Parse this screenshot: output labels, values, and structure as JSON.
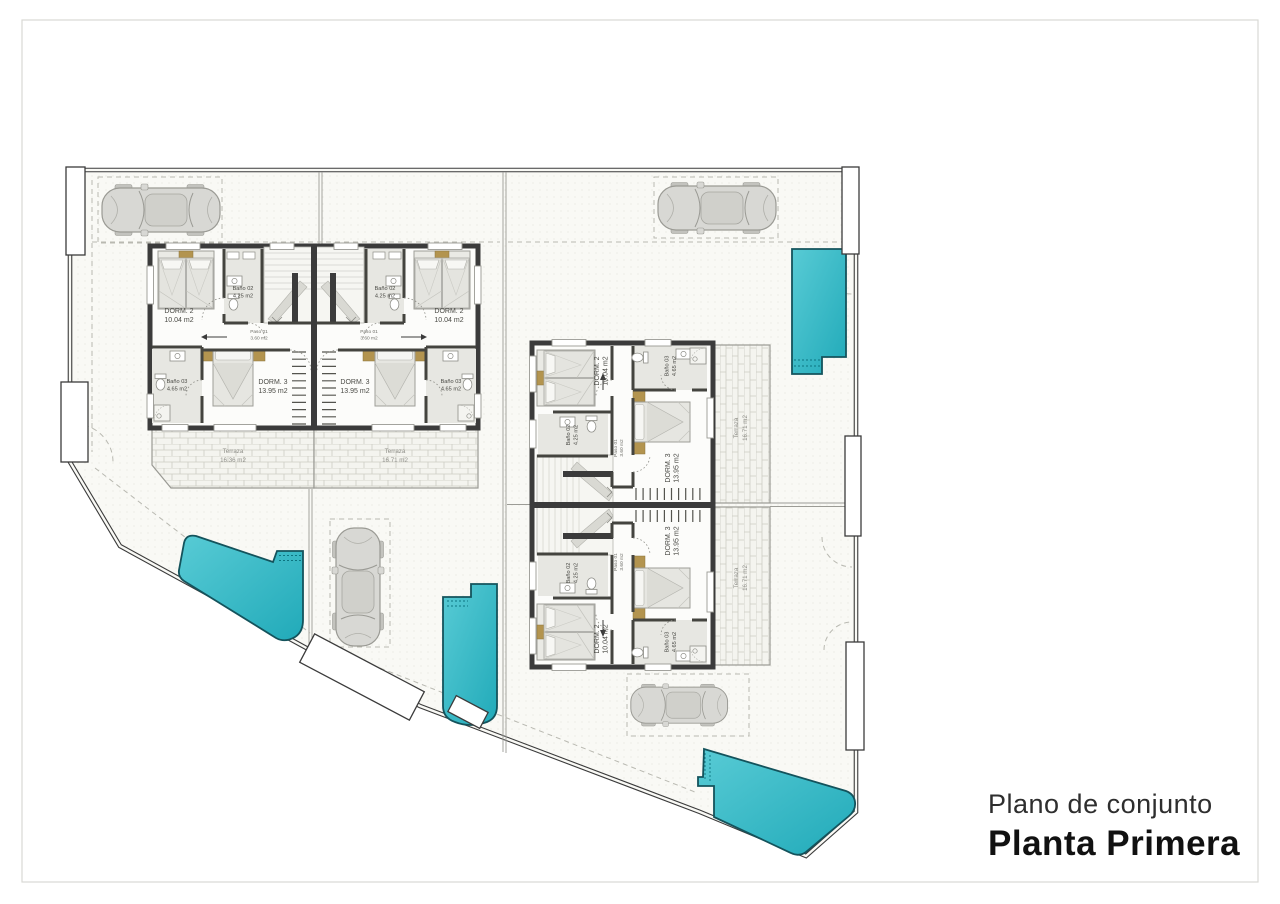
{
  "sheet": {
    "subtitle": "Plano de conjunto",
    "title": "Planta Primera"
  },
  "rooms": {
    "dorm2": {
      "name": "DORM. 2",
      "area": "10.04 m2"
    },
    "bano02": {
      "name": "Baño 02",
      "area": "4.25 m2"
    },
    "paso01": {
      "name": "Paso 01",
      "area": "3.60 m2"
    },
    "dorm3": {
      "name": "DORM. 3",
      "area": "13.95 m2"
    },
    "bano03": {
      "name": "Baño 03",
      "area": "4.65 m2"
    },
    "terraza_left": {
      "name": "Terraza",
      "area": "16.36 m2"
    },
    "terraza_right": {
      "name": "Terraza",
      "area": "16.71 m2"
    }
  },
  "colors": {
    "pool": "#3fc0cb",
    "pool_deep": "#21aab9",
    "wall": "#3b3b3b",
    "wood_accent": "#b3944f"
  }
}
